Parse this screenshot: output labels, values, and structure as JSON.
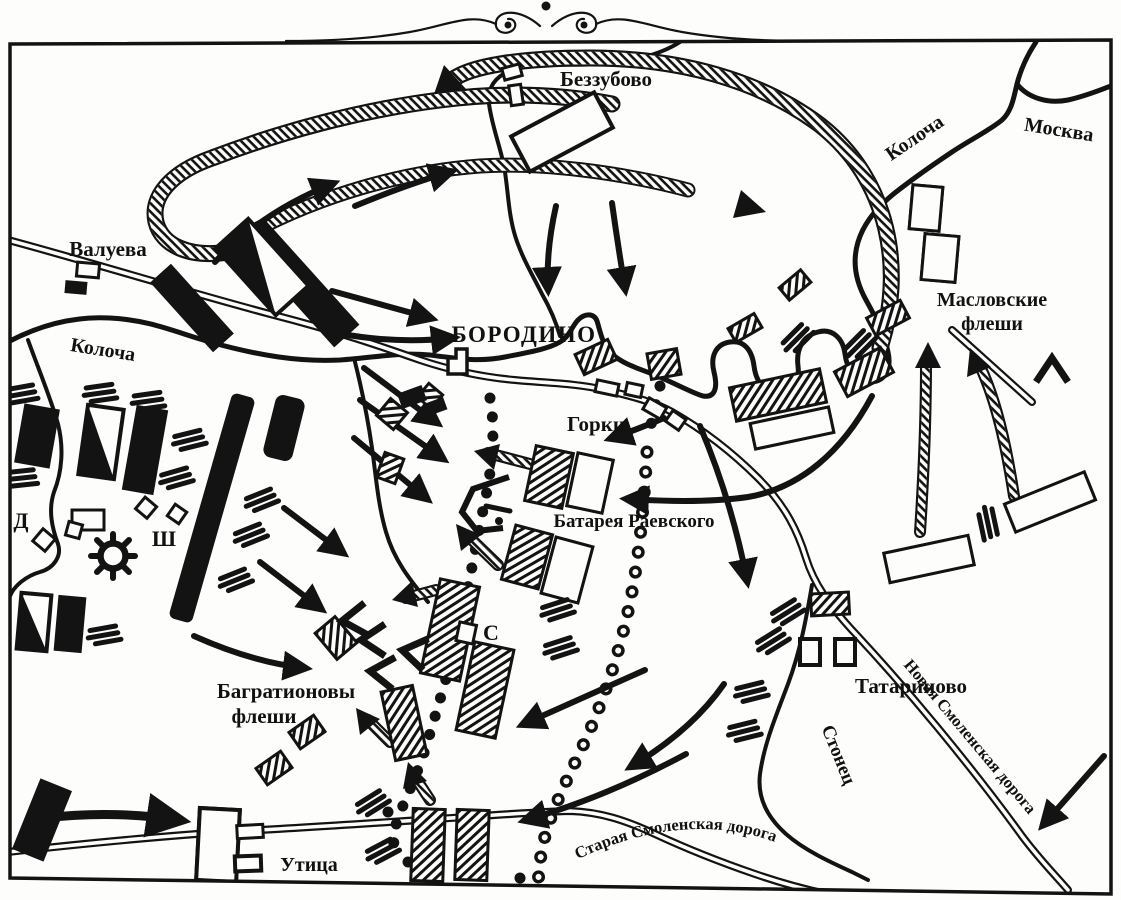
{
  "colors": {
    "ink": "#131313",
    "paper": "#ffffff"
  },
  "places": {
    "bezzubovo": "Беззубово",
    "valueva": "Валуева",
    "borodino": "БОРОДИНО",
    "gorki": "Горки",
    "tatarinovo": "Татариново",
    "utitsa": "Утица",
    "semyonovskoye_initial": "С",
    "shevardino_initial": "Ш",
    "doronino_initial": "Д"
  },
  "fortifications": {
    "maslovskie_line1": "Масловские",
    "maslovskie_line2": "флеши",
    "raevsky_battery": "Батарея Раевского",
    "bagration_line1": "Багратионовы",
    "bagration_line2": "флеши"
  },
  "rivers": {
    "kolocha_west": "Колоча",
    "kolocha_east": "Колоча",
    "moskva": "Москва",
    "stonets": "Стонец"
  },
  "roads": {
    "new_smolensk": "Новая Смоленская дорога",
    "old_smolensk": "Старая Смоленская дорога"
  }
}
